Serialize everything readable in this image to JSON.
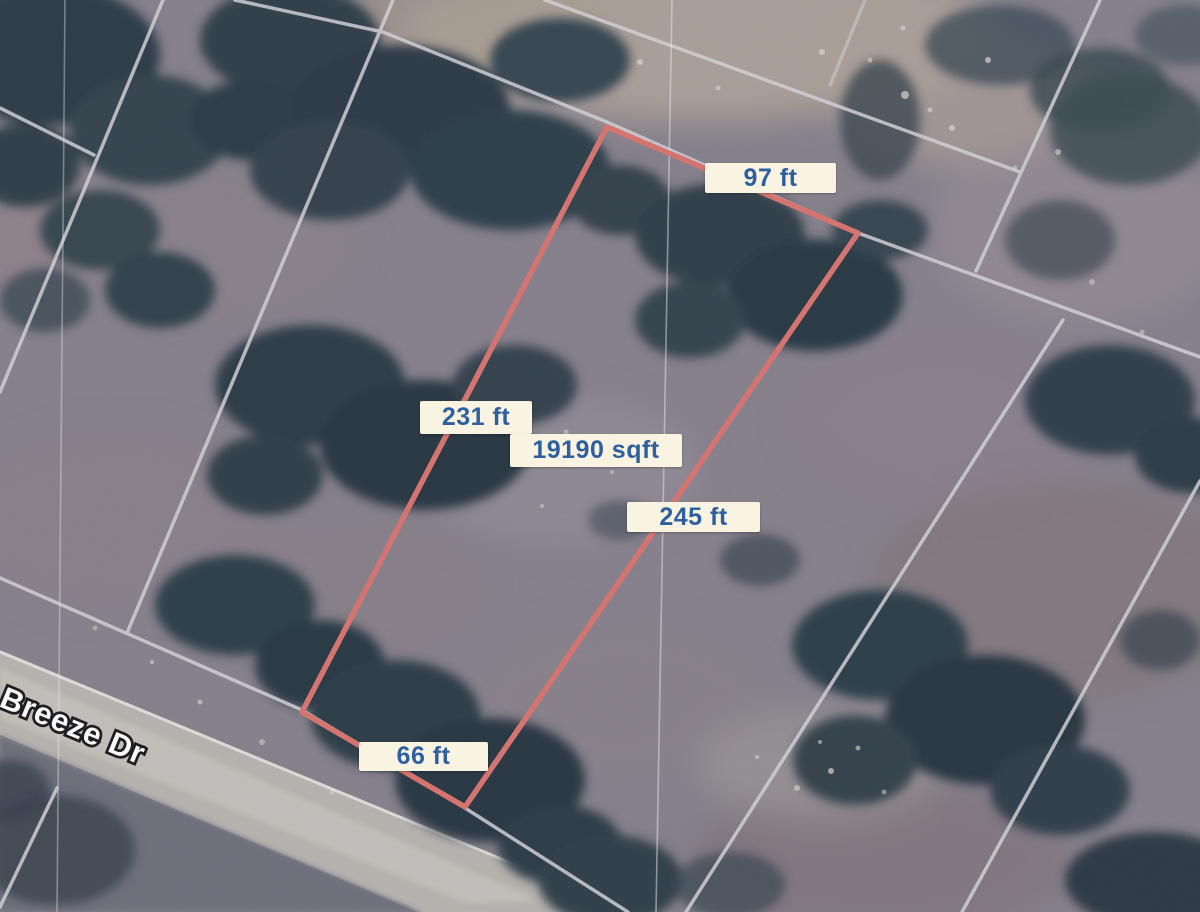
{
  "map": {
    "street_label": "Breeze Dr",
    "colors": {
      "parcel_outline": "#d9736e",
      "dimension_label_background": "#f9f4e2",
      "dimension_label_text": "#2e5f9e",
      "lot_lines": "#d4d2d8",
      "road_surface": "#b8b4af",
      "street_label_text": "#ffffff",
      "street_label_outline": "#18181a"
    }
  },
  "parcel": {
    "area": "19190 sqft",
    "dimensions": {
      "top": "97 ft",
      "left": "231 ft",
      "right": "245 ft",
      "bottom": "66 ft"
    }
  }
}
